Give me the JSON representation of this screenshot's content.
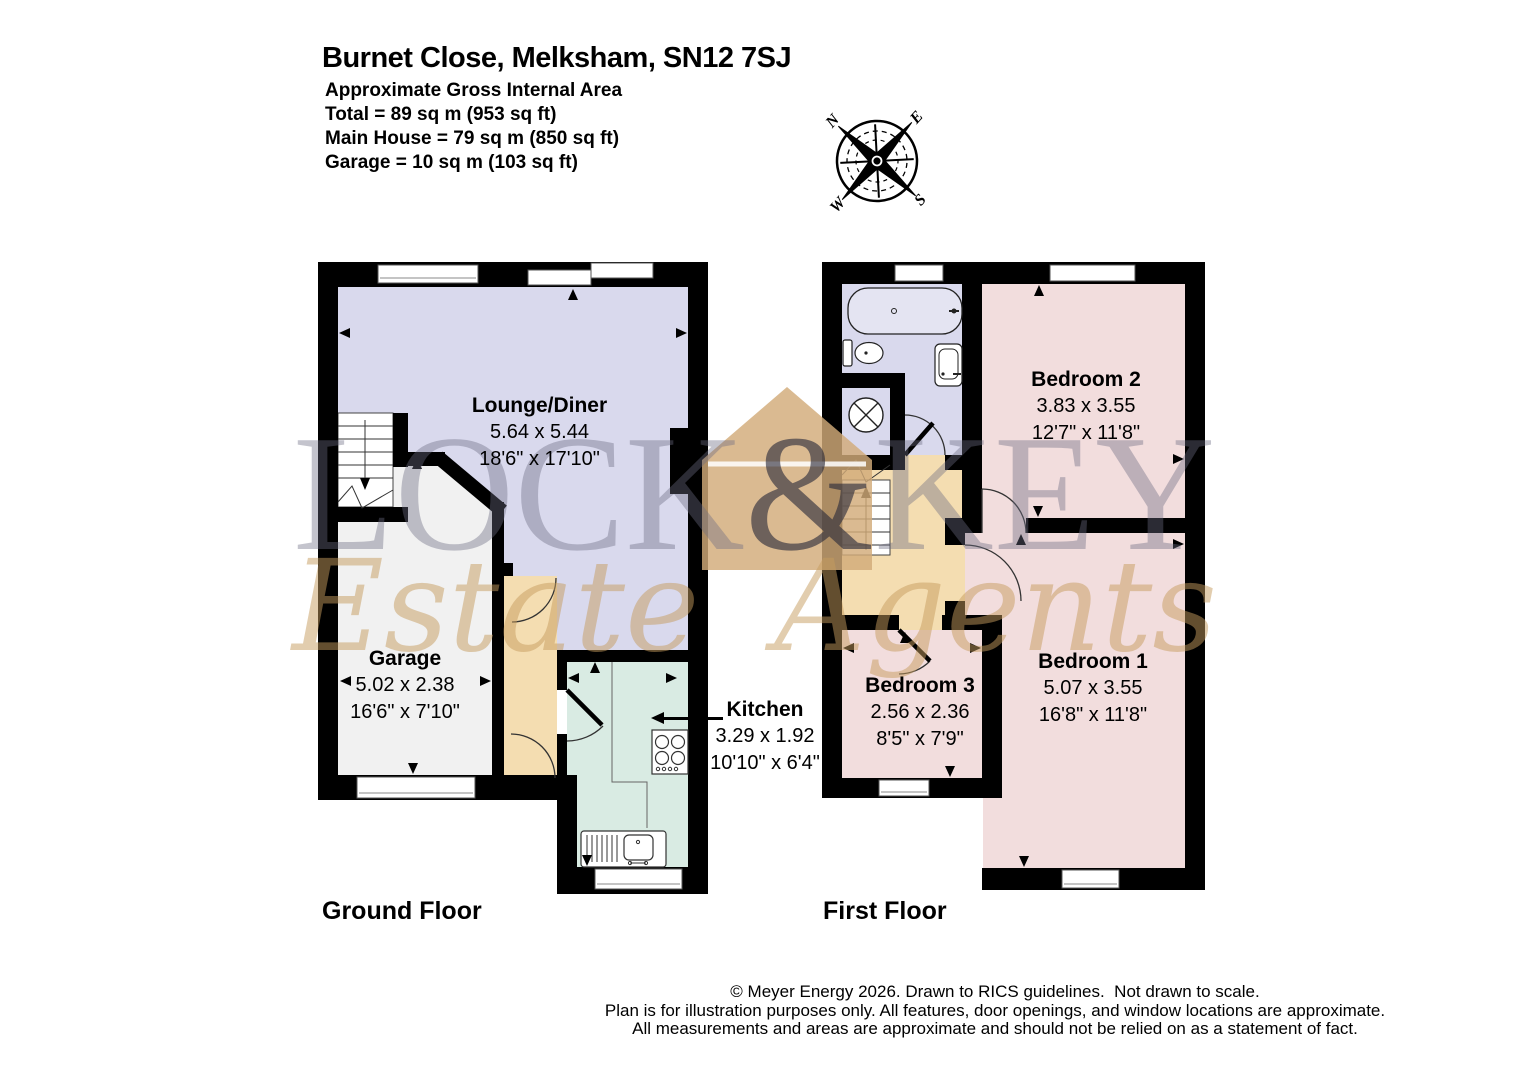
{
  "header": {
    "title": "Burnet Close, Melksham, SN12 7SJ",
    "area_heading": "Approximate Gross Internal Area",
    "total": "Total = 89 sq m (953 sq ft)",
    "main_house": "Main House = 79 sq m (850 sq ft)",
    "garage": "Garage = 10 sq m (103 sq ft)"
  },
  "compass": {
    "north": "N",
    "east": "E",
    "south": "S",
    "west": "W"
  },
  "watermark": {
    "letters": [
      "L",
      "O",
      "C",
      "K",
      "&",
      "K",
      "E",
      "Y"
    ],
    "script_words": [
      "Estate",
      "Agents"
    ]
  },
  "floors": {
    "ground": {
      "label": "Ground Floor",
      "rooms": {
        "lounge": {
          "name": "Lounge/Diner",
          "metric": "5.64 x 5.44",
          "imperial": "18'6\" x 17'10\""
        },
        "garage": {
          "name": "Garage",
          "metric": "5.02 x 2.38",
          "imperial": "16'6\" x 7'10\""
        },
        "kitchen": {
          "name": "Kitchen",
          "metric": "3.29 x 1.92",
          "imperial": "10'10\" x 6'4\""
        }
      }
    },
    "first": {
      "label": "First Floor",
      "rooms": {
        "bedroom2": {
          "name": "Bedroom 2",
          "metric": "3.83 x 3.55",
          "imperial": "12'7\" x 11'8\""
        },
        "bedroom3": {
          "name": "Bedroom 3",
          "metric": "2.56 x 2.36",
          "imperial": "8'5\" x 7'9\""
        },
        "bedroom1": {
          "name": "Bedroom 1",
          "metric": "5.07 x 3.55",
          "imperial": "16'8\" x 11'8\""
        }
      }
    }
  },
  "footer": {
    "line1": "© Meyer Energy 2026. Drawn to RICS guidelines.  Not drawn to scale.",
    "line2": "Plan is for illustration purposes only. All features, door openings, and window locations are approximate.",
    "line3": "All measurements and areas are approximate and should not be relied on as a statement of fact."
  },
  "colors": {
    "wall": "#000000",
    "lounge_fill": "#d9d9ed",
    "bedroom_fill": "#f2dddd",
    "hall_fill": "#f4ddb1",
    "kitchen_fill": "#d9ebe3",
    "garage_fill": "#f1f1f1",
    "window_fill": "#ffffff",
    "watermark_gray": "#9c9cae",
    "watermark_tan": "#d2ab79"
  }
}
